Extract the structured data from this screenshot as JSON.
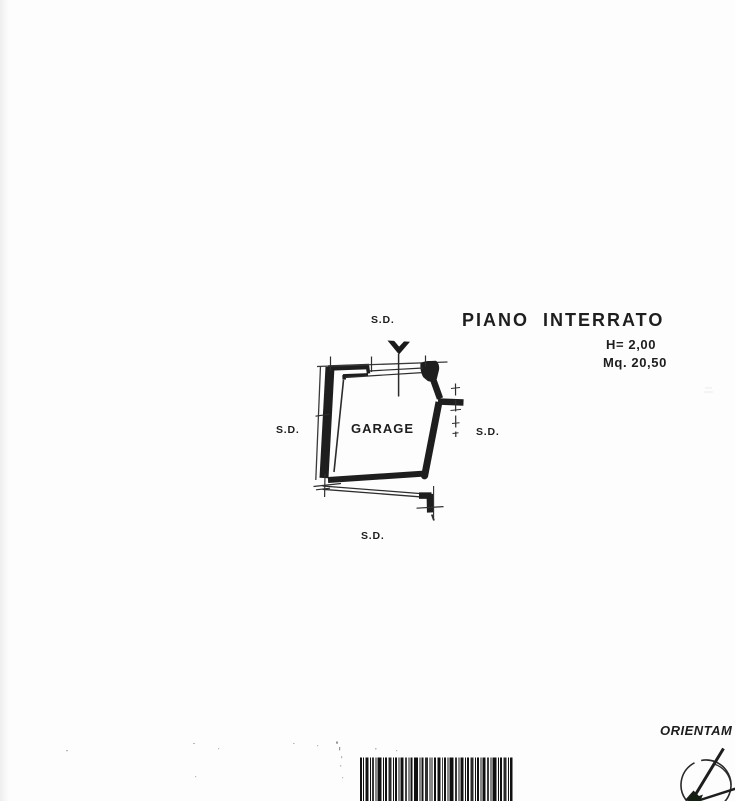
{
  "page": {
    "kind": "scanned floor plan sheet",
    "paper_color": "#fdfdfd",
    "ink_color": "#1e1e1e"
  },
  "plan": {
    "title": "PIANO INTERRATO",
    "height_label": "H= 2,00",
    "area_label": "Mq. 20,50",
    "room_label": "GARAGE",
    "boundary_labels": {
      "top": "S.D.",
      "left": "S.D.",
      "right": "S.D.",
      "bottom": "S.D."
    }
  },
  "footer": {
    "orientation_label": "ORIENTAM"
  }
}
